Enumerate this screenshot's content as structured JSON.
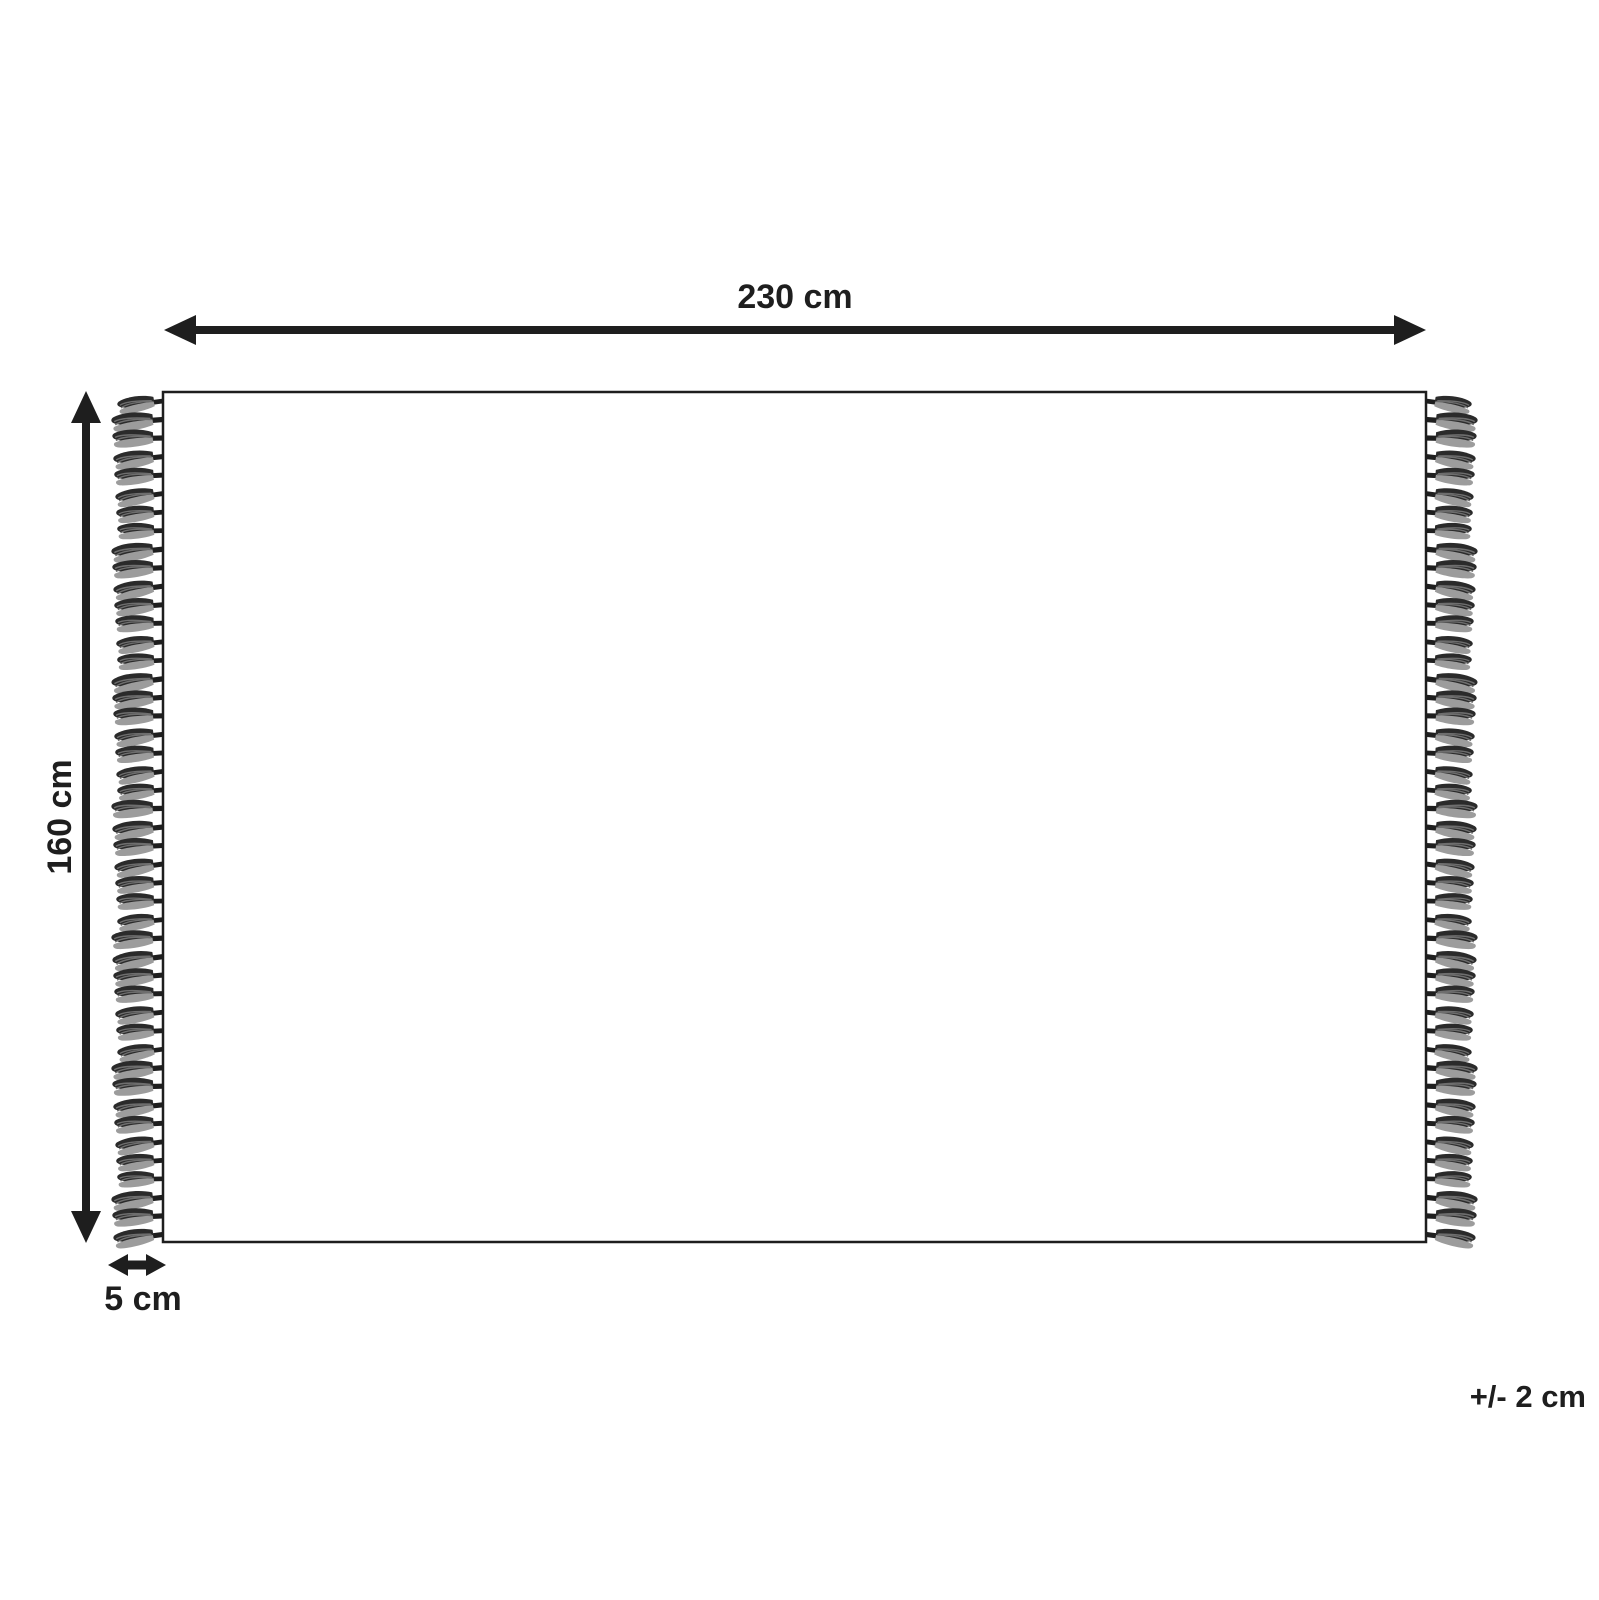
{
  "diagram": {
    "width_label": "230 cm",
    "height_label": "160 cm",
    "fringe_width_label": "5 cm",
    "tolerance_label": "+/- 2 cm",
    "colors": {
      "line": "#1e1e1e",
      "background": "#ffffff",
      "tassel_dark": "#2b2b2b",
      "tassel_mid": "#6e6e6e",
      "tassel_light": "#9c9c9c"
    },
    "fringe": {
      "sides": [
        "left",
        "right"
      ],
      "tassels_per_side": 46
    }
  }
}
